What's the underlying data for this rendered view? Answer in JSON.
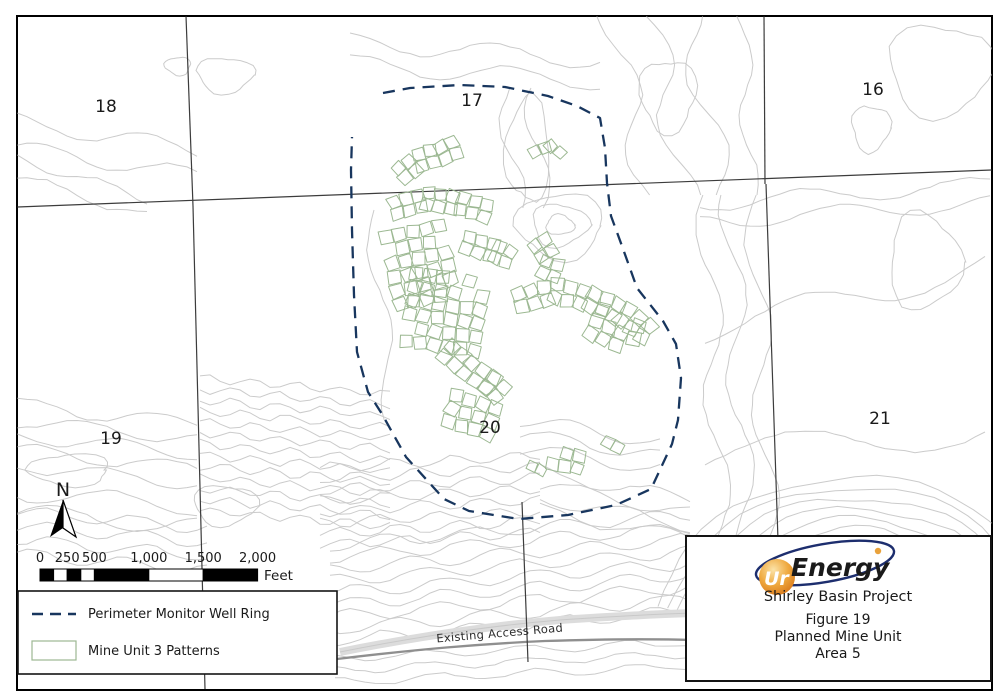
{
  "colors": {
    "ring_navy": "#18365e",
    "pattern_green": "#9cb892",
    "contour_gray": "#cbcbcb",
    "section_line": "#3c3c3c",
    "road_light": "#dcdcdc",
    "road_dark": "#8f8f8f",
    "logo_navy": "#1d2e6e",
    "logo_orange": "#e08a21",
    "logo_gold": "#e9a23b",
    "text": "#1a1a1a"
  },
  "map": {
    "frame": {
      "x": 17,
      "y": 16,
      "w": 975,
      "h": 674
    },
    "north": {
      "label": "N"
    },
    "road": {
      "band": "M340,652 C430,634 500,625 560,620 C620,616 660,614 692,613",
      "dark": "M337,659 C420,649 480,644 545,641 C610,639 660,639 692,640",
      "label": "Existing Access Road"
    },
    "section_labels": [
      {
        "text": "18",
        "x": 106,
        "y": 112
      },
      {
        "text": "17",
        "x": 472,
        "y": 106
      },
      {
        "text": "16",
        "x": 873,
        "y": 95
      },
      {
        "text": "19",
        "x": 111,
        "y": 444
      },
      {
        "text": "20",
        "x": 490,
        "y": 433
      },
      {
        "text": "21",
        "x": 880,
        "y": 424
      }
    ],
    "section_lines": [
      [
        17,
        207,
        992,
        170
      ],
      [
        186,
        16,
        193,
        206
      ],
      [
        764,
        16,
        765,
        184
      ],
      [
        193,
        206,
        205,
        689
      ],
      [
        766,
        184,
        778,
        540
      ],
      [
        522,
        502,
        528,
        662
      ]
    ],
    "ring": {
      "dash": "12 8",
      "width": 2.3,
      "points": [
        [
          383,
          93
        ],
        [
          410,
          88
        ],
        [
          460,
          85
        ],
        [
          505,
          87
        ],
        [
          548,
          96
        ],
        [
          577,
          106
        ],
        [
          600,
          118
        ],
        [
          605,
          148
        ],
        [
          607,
          183
        ],
        [
          611,
          216
        ],
        [
          622,
          246
        ],
        [
          637,
          288
        ],
        [
          663,
          321
        ],
        [
          676,
          344
        ],
        [
          681,
          378
        ],
        [
          678,
          420
        ],
        [
          672,
          444
        ],
        [
          651,
          489
        ],
        [
          616,
          505
        ],
        [
          568,
          515
        ],
        [
          519,
          519
        ],
        [
          469,
          511
        ],
        [
          444,
          499
        ],
        [
          406,
          457
        ],
        [
          382,
          414
        ],
        [
          368,
          392
        ],
        [
          357,
          352
        ],
        [
          354,
          295
        ],
        [
          352,
          230
        ],
        [
          351,
          170
        ],
        [
          352,
          137
        ]
      ]
    },
    "scale_bar": {
      "x": 40,
      "bar_y": 569,
      "bar_h": 12,
      "label_y": 562,
      "px_per_250ft": 27.2,
      "unit": "Feet",
      "ticks": [
        {
          "t": "0",
          "f": 0
        },
        {
          "t": "250",
          "f": 250
        },
        {
          "t": "500",
          "f": 500
        },
        {
          "t": "1,000",
          "f": 1000
        },
        {
          "t": "1,500",
          "f": 1500
        },
        {
          "t": "2,000",
          "f": 2000
        }
      ],
      "segments": [
        {
          "f0": 0,
          "f1": 125,
          "fill": "#000000"
        },
        {
          "f0": 125,
          "f1": 250,
          "fill": "#ffffff"
        },
        {
          "f0": 250,
          "f1": 375,
          "fill": "#000000"
        },
        {
          "f0": 375,
          "f1": 500,
          "fill": "#ffffff"
        },
        {
          "f0": 500,
          "f1": 1000,
          "fill": "#000000"
        },
        {
          "f0": 1000,
          "f1": 1500,
          "fill": "#ffffff"
        },
        {
          "f0": 1500,
          "f1": 2000,
          "fill": "#000000"
        }
      ]
    },
    "contours": {
      "waves": [
        {
          "x0": 17,
          "x1": 200,
          "y0": 122,
          "y1": 150,
          "n": 2,
          "gap": 26,
          "amp": 8,
          "wl": 130,
          "seed": 1
        },
        {
          "x0": 17,
          "x1": 150,
          "y0": 158,
          "y1": 200,
          "n": 2,
          "gap": 18,
          "amp": 5,
          "wl": 100,
          "seed": 2
        },
        {
          "x0": 700,
          "x1": 992,
          "y0": 204,
          "y1": 184,
          "n": 2,
          "gap": 18,
          "amp": 8,
          "wl": 160,
          "seed": 3
        },
        {
          "x0": 705,
          "x1": 992,
          "y0": 330,
          "y1": 265,
          "n": 1,
          "gap": 0,
          "amp": 14,
          "wl": 210,
          "seed": 4
        },
        {
          "x0": 705,
          "x1": 992,
          "y0": 455,
          "y1": 430,
          "n": 1,
          "gap": 0,
          "amp": 16,
          "wl": 260,
          "seed": 5
        },
        {
          "x0": 17,
          "x1": 205,
          "y0": 405,
          "y1": 425,
          "n": 5,
          "gap": 15,
          "amp": 7,
          "wl": 130,
          "seed": 6
        },
        {
          "x0": 17,
          "x1": 200,
          "y0": 492,
          "y1": 507,
          "n": 2,
          "gap": 20,
          "amp": 9,
          "wl": 150,
          "seed": 7
        },
        {
          "x0": 200,
          "x1": 395,
          "y0": 378,
          "y1": 395,
          "n": 13,
          "gap": 11,
          "amp": 4,
          "wl": 45,
          "seed": 8
        },
        {
          "x0": 320,
          "x1": 545,
          "y0": 468,
          "y1": 455,
          "n": 8,
          "gap": 11,
          "amp": 5,
          "wl": 60,
          "seed": 9
        },
        {
          "x0": 330,
          "x1": 690,
          "y0": 545,
          "y1": 515,
          "n": 9,
          "gap": 12,
          "amp": 6,
          "wl": 90,
          "seed": 10
        },
        {
          "x0": 335,
          "x1": 690,
          "y0": 658,
          "y1": 642,
          "n": 3,
          "gap": 12,
          "amp": 4,
          "wl": 100,
          "seed": 11
        },
        {
          "x0": 540,
          "x1": 690,
          "y0": 472,
          "y1": 500,
          "n": 4,
          "gap": 13,
          "amp": 7,
          "wl": 120,
          "seed": 12
        },
        {
          "x0": 520,
          "x1": 660,
          "y0": 420,
          "y1": 442,
          "n": 3,
          "gap": 14,
          "amp": 7,
          "wl": 110,
          "seed": 13
        },
        {
          "x0": 350,
          "x1": 600,
          "y0": 42,
          "y1": 60,
          "n": 2,
          "gap": 22,
          "amp": 9,
          "wl": 150,
          "seed": 14
        },
        {
          "x0": 17,
          "x1": 210,
          "y0": 512,
          "y1": 528,
          "n": 4,
          "gap": 14,
          "amp": 6,
          "wl": 90,
          "seed": 15
        }
      ],
      "vwaves": [
        {
          "y0": 15,
          "y1": 195,
          "x0": 612,
          "x1": 648,
          "n": 3,
          "gap": 38,
          "amp": 15,
          "wl": 140,
          "seed": 16
        },
        {
          "y0": 88,
          "y1": 208,
          "x0": 505,
          "x1": 518,
          "n": 2,
          "gap": 26,
          "amp": 10,
          "wl": 120,
          "seed": 17
        },
        {
          "y0": 195,
          "y1": 555,
          "x0": 706,
          "x1": 722,
          "n": 3,
          "gap": 24,
          "amp": 12,
          "wl": 170,
          "seed": 18
        },
        {
          "y0": 210,
          "y1": 420,
          "x0": 372,
          "x1": 392,
          "n": 1,
          "gap": 0,
          "amp": 9,
          "wl": 150,
          "seed": 19
        },
        {
          "y0": 15,
          "y1": 200,
          "x0": 742,
          "x1": 752,
          "n": 1,
          "gap": 0,
          "amp": 8,
          "wl": 120,
          "seed": 20
        }
      ],
      "blobs": [
        {
          "cx": 225,
          "cy": 75,
          "rx": 28,
          "ry": 18,
          "seed": 21
        },
        {
          "cx": 178,
          "cy": 66,
          "rx": 13,
          "ry": 9,
          "seed": 22
        },
        {
          "cx": 560,
          "cy": 225,
          "rx": 14,
          "ry": 10,
          "seed": 23
        },
        {
          "cx": 560,
          "cy": 225,
          "rx": 28,
          "ry": 21,
          "seed": 24
        },
        {
          "cx": 560,
          "cy": 226,
          "rx": 43,
          "ry": 33,
          "seed": 25
        },
        {
          "cx": 668,
          "cy": 95,
          "rx": 28,
          "ry": 36,
          "seed": 26
        },
        {
          "cx": 940,
          "cy": 70,
          "rx": 52,
          "ry": 46,
          "seed": 27
        },
        {
          "cx": 871,
          "cy": 128,
          "rx": 19,
          "ry": 23,
          "seed": 28
        },
        {
          "cx": 925,
          "cy": 262,
          "rx": 36,
          "ry": 48,
          "seed": 29
        },
        {
          "cx": 528,
          "cy": 150,
          "rx": 22,
          "ry": 52,
          "seed": 30
        },
        {
          "cx": 70,
          "cy": 470,
          "rx": 40,
          "ry": 16,
          "seed": 31
        },
        {
          "cx": 225,
          "cy": 505,
          "rx": 32,
          "ry": 20,
          "seed": 32
        }
      ],
      "arcs": [
        {
          "cx": 855,
          "cy": 640,
          "r0": 100,
          "dr": 13,
          "n": 9,
          "a0": 192,
          "a1": 348,
          "seed": 33
        }
      ]
    },
    "patterns": {
      "grids": [
        {
          "cx": 420,
          "cy": 265,
          "cols": 5,
          "rows": 6,
          "cell": 13,
          "rot": -12,
          "seed": 41
        },
        {
          "cx": 445,
          "cy": 312,
          "cols": 6,
          "rows": 6,
          "cell": 13,
          "rot": 8,
          "seed": 42
        },
        {
          "cx": 615,
          "cy": 330,
          "cols": 4,
          "rows": 3,
          "cell": 13,
          "rot": 25,
          "seed": 43
        },
        {
          "cx": 472,
          "cy": 415,
          "cols": 4,
          "rows": 3,
          "cell": 13,
          "rot": 18,
          "seed": 44
        },
        {
          "cx": 566,
          "cy": 460,
          "cols": 3,
          "rows": 2,
          "cell": 12,
          "rot": 10,
          "seed": 45
        }
      ],
      "bands": [
        {
          "pts": [
            [
              402,
              173
            ],
            [
              420,
              160
            ],
            [
              443,
              153
            ],
            [
              462,
              144
            ]
          ],
          "rows": 2,
          "cell": 12,
          "seed": 51
        },
        {
          "pts": [
            [
              535,
              152
            ],
            [
              551,
              146
            ],
            [
              566,
              157
            ]
          ],
          "rows": 1,
          "cell": 11,
          "seed": 52
        },
        {
          "pts": [
            [
              396,
              208
            ],
            [
              428,
              199
            ],
            [
              462,
              204
            ],
            [
              497,
              214
            ]
          ],
          "rows": 2,
          "cell": 12,
          "seed": 53
        },
        {
          "pts": [
            [
              468,
              243
            ],
            [
              497,
              252
            ],
            [
              518,
              262
            ]
          ],
          "rows": 2,
          "cell": 12,
          "seed": 54
        },
        {
          "pts": [
            [
              540,
              243
            ],
            [
              552,
              263
            ],
            [
              546,
              283
            ]
          ],
          "rows": 2,
          "cell": 12,
          "seed": 55
        },
        {
          "pts": [
            [
              520,
              300
            ],
            [
              556,
              291
            ],
            [
              592,
              300
            ],
            [
              625,
              315
            ],
            [
              652,
              336
            ]
          ],
          "rows": 2,
          "cell": 13,
          "seed": 56
        },
        {
          "pts": [
            [
              448,
              352
            ],
            [
              468,
              368
            ],
            [
              490,
              383
            ],
            [
              506,
              398
            ]
          ],
          "rows": 2,
          "cell": 13,
          "seed": 57
        },
        {
          "pts": [
            [
              608,
              442
            ],
            [
              619,
              448
            ]
          ],
          "rows": 1,
          "cell": 11,
          "seed": 58
        },
        {
          "pts": [
            [
              532,
              466
            ],
            [
              542,
              471
            ]
          ],
          "rows": 1,
          "cell": 10,
          "seed": 59
        }
      ]
    }
  },
  "legend": {
    "items": [
      {
        "label": "Perimeter Monitor Well Ring",
        "swatch": "dashed-line"
      },
      {
        "label": "Mine Unit 3 Patterns",
        "swatch": "rect"
      }
    ]
  },
  "title_block": {
    "logo_prefix": "Ur",
    "logo_suffix": "Energy",
    "project": "Shirley Basin Project",
    "figure": "Figure 19",
    "subject": "Planned Mine Unit",
    "area": "Area 5"
  }
}
